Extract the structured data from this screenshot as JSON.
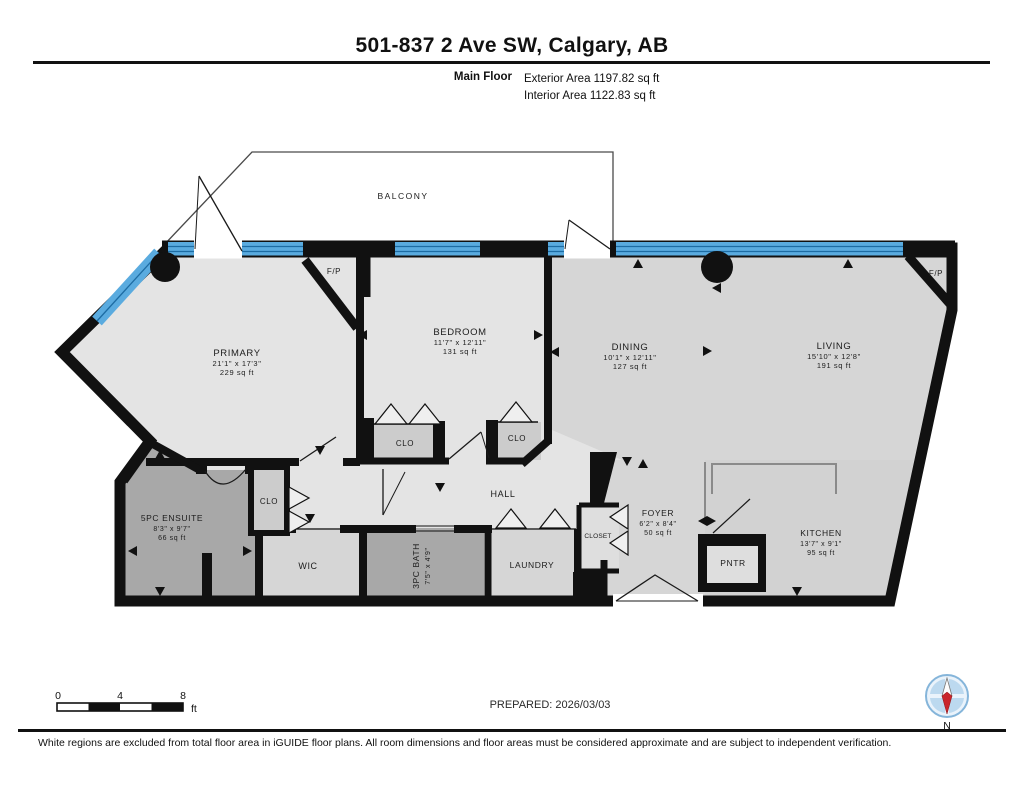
{
  "header": {
    "title": "501-837 2 Ave SW, Calgary, AB",
    "floor_label": "Main Floor",
    "exterior_area": "Exterior Area 1197.82 sq ft",
    "interior_area": "Interior Area 1122.83 sq ft"
  },
  "plan": {
    "balcony": "BALCONY",
    "fireplace": "F/P",
    "rooms": {
      "primary": {
        "name": "PRIMARY",
        "dims": "21'1\" x 17'3\"",
        "area": "229 sq ft"
      },
      "bedroom": {
        "name": "BEDROOM",
        "dims": "11'7\" x 12'11\"",
        "area": "131 sq ft"
      },
      "dining": {
        "name": "DINING",
        "dims": "10'1\" x 12'11\"",
        "area": "127 sq ft"
      },
      "living": {
        "name": "LIVING",
        "dims": "15'10\" x 12'8\"",
        "area": "191 sq ft"
      },
      "kitchen": {
        "name": "KITCHEN",
        "dims": "13'7\" x 9'1\"",
        "area": "95 sq ft"
      },
      "foyer": {
        "name": "FOYER",
        "dims": "6'2\" x 8'4\"",
        "area": "50 sq ft"
      },
      "ensuite": {
        "name": "5PC ENSUITE",
        "dims": "8'3\" x 9'7\"",
        "area": "66 sq ft"
      },
      "bath": {
        "name": "3PC BATH",
        "dims": "7'5\" x 4'9\""
      },
      "hall": {
        "name": "HALL"
      },
      "laundry": {
        "name": "LAUNDRY"
      },
      "wic": {
        "name": "WIC"
      },
      "closet": {
        "name": "CLOSET"
      },
      "pantry": {
        "name": "PNTR"
      },
      "clo": {
        "name": "CLO"
      }
    }
  },
  "footer": {
    "scale": {
      "tick0": "0",
      "tick1": "4",
      "tick2": "8",
      "unit": "ft"
    },
    "prepared": "PREPARED: 2026/03/03",
    "compass_n": "N"
  },
  "disclaimer": "White regions are excluded from total floor area in iGUIDE floor plans. All room dimensions and floor areas must be considered approximate and are subject to independent verification.",
  "colors": {
    "wall": "#111111",
    "window_blue": "#5aabdf",
    "window_line_blue": "#1d6ca3",
    "room_light": "#e4e4e4",
    "room_mid": "#d6d6d6",
    "room_dark": "#a8a8a8",
    "compass_red": "#c9252b",
    "compass_blue": "#bcd9ef"
  }
}
